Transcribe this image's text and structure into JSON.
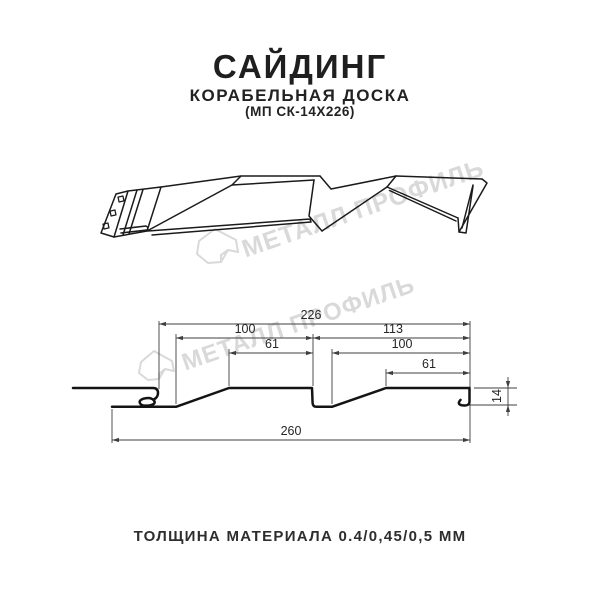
{
  "header": {
    "title": "САЙДИНГ",
    "subtitle": "КОРАБЕЛЬНАЯ ДОСКА",
    "model": "(МП СК-14Х226)"
  },
  "watermark": {
    "text": "МЕТАЛЛ ПРОФИЛЬ"
  },
  "section_dimensions": {
    "total_top": "226",
    "left_100": "100",
    "right_113": "113",
    "left_61": "61",
    "right_100": "100",
    "right_61": "61",
    "overall_bottom": "260",
    "height_14": "14"
  },
  "footer": {
    "thickness_label": "ТОЛЩИНА МАТЕРИАЛА 0.4/0,45/0,5 ММ"
  },
  "colors": {
    "drawing_line": "#1b1b1b",
    "dimension_line": "#3f3f3f",
    "watermark": "#d9d9d9",
    "background": "#ffffff"
  }
}
